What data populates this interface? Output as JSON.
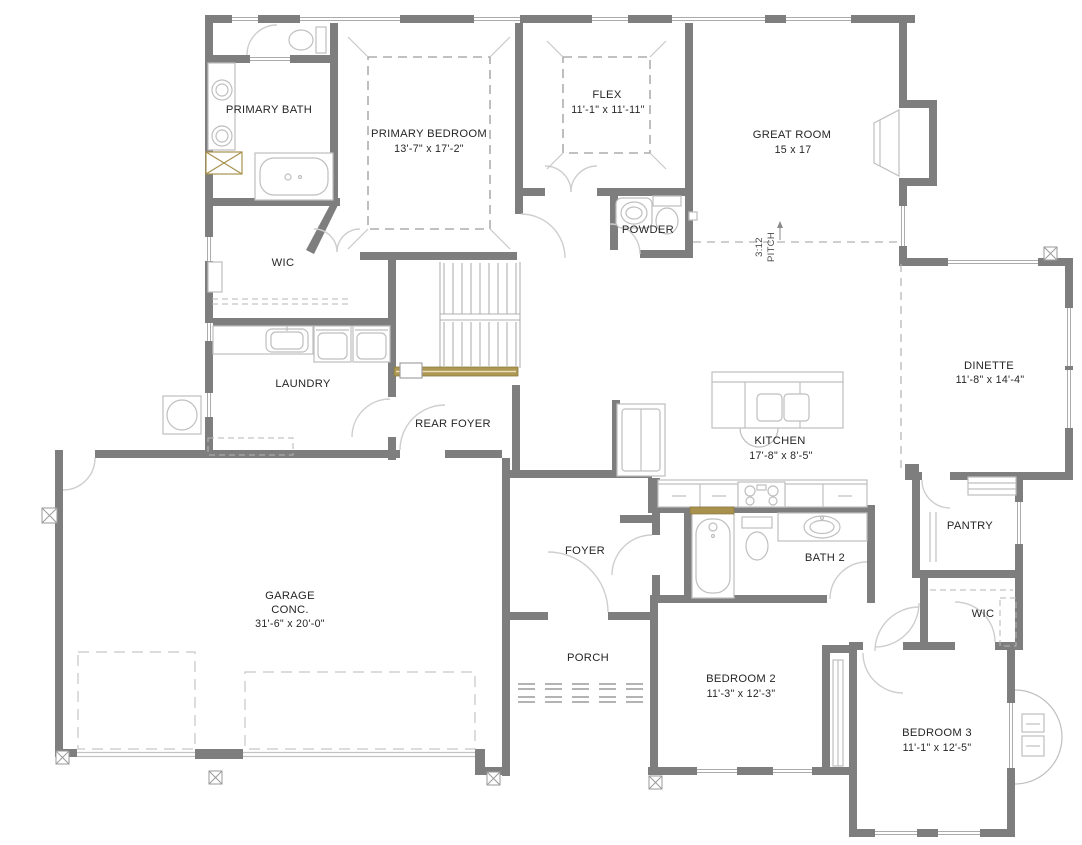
{
  "plan": {
    "title": "Floor Plan",
    "rooms": {
      "primary_bath": {
        "name": "PRIMARY BATH"
      },
      "primary_bedroom": {
        "name": "PRIMARY BEDROOM",
        "dims": "13'-7\" x 17'-2\""
      },
      "flex": {
        "name": "FLEX",
        "dims": "11'-1\" x 11'-11\""
      },
      "great_room": {
        "name": "GREAT ROOM",
        "dims": "15 x 17"
      },
      "powder": {
        "name": "POWDER"
      },
      "wic_primary": {
        "name": "WIC"
      },
      "laundry": {
        "name": "LAUNDRY"
      },
      "rear_foyer": {
        "name": "REAR FOYER"
      },
      "kitchen": {
        "name": "KITCHEN",
        "dims": "17'-8\" x 8'-5\""
      },
      "dinette": {
        "name": "DINETTE",
        "dims": "11'-8\" x 14'-4\""
      },
      "pantry": {
        "name": "PANTRY"
      },
      "foyer": {
        "name": "FOYER"
      },
      "bath_2": {
        "name": "BATH 2"
      },
      "garage": {
        "name": "GARAGE",
        "material": "CONC.",
        "dims": "31'-6\" x 20'-0\""
      },
      "porch": {
        "name": "PORCH"
      },
      "bedroom_2": {
        "name": "BEDROOM 2",
        "dims": "11'-3\" x 12'-3\""
      },
      "wic_2": {
        "name": "WIC"
      },
      "bedroom_3": {
        "name": "BEDROOM 3",
        "dims": "11'-1\" x 12'-5\""
      }
    },
    "annotations": {
      "roof_pitch": "3:12",
      "roof_pitch_label": "PITCH"
    },
    "colors": {
      "wall": "#7e7e7e",
      "fixture": "#bfbfbf",
      "accent_tan": "#a8914d",
      "text": "#262626"
    }
  }
}
